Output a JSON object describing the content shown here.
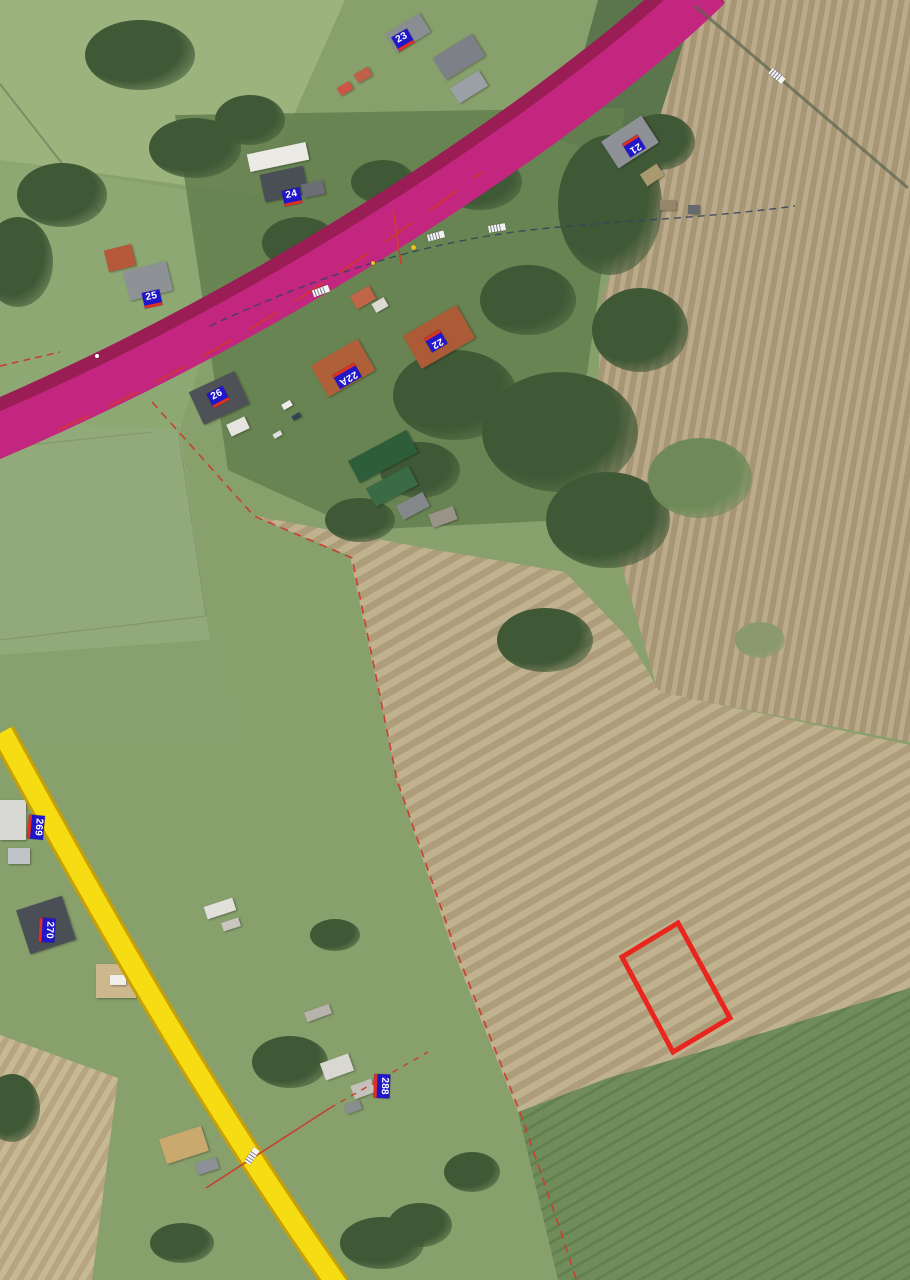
{
  "map": {
    "type": "aerial-orthophoto-with-cadastral-overlay",
    "colors": {
      "road_primary_fill": "#c2267f",
      "road_primary_casing": "#9a1d55",
      "road_primary_edge_red": "#d4372a",
      "road_secondary_fill": "#f6dc12",
      "road_secondary_casing": "#c79f06",
      "parcel_highlight": "#e8261d",
      "boundary_red": "#c8402f",
      "utility_dashed": "#34465c",
      "track_line": "#5a6450",
      "house_label_bg": "#1f17c9",
      "house_label_text": "#ffffff",
      "house_label_underline": "#e03020",
      "marker_yellow": "#e6c31e",
      "marker_white": "#ffffff"
    },
    "house_labels": [
      {
        "text": "23",
        "x": 403,
        "y": 40,
        "rot": -30
      },
      {
        "text": "24",
        "x": 292,
        "y": 197,
        "rot": -12
      },
      {
        "text": "25",
        "x": 152,
        "y": 299,
        "rot": -12
      },
      {
        "text": "21",
        "x": 634,
        "y": 146,
        "rot": 148
      },
      {
        "text": "22",
        "x": 436,
        "y": 341,
        "rot": 150
      },
      {
        "text": "22A",
        "x": 347,
        "y": 376,
        "rot": 150
      },
      {
        "text": "26",
        "x": 218,
        "y": 397,
        "rot": -28
      },
      {
        "text": "269",
        "x": 36,
        "y": 827,
        "rot": 95
      },
      {
        "text": "270",
        "x": 47,
        "y": 930,
        "rot": 93
      },
      {
        "text": "288",
        "x": 382,
        "y": 1086,
        "rot": 92
      }
    ],
    "road_ref_labels": [
      {
        "x": 321,
        "y": 291,
        "rot": -20
      },
      {
        "x": 436,
        "y": 236,
        "rot": -15
      },
      {
        "x": 497,
        "y": 228,
        "rot": -10
      },
      {
        "x": 777,
        "y": 76,
        "rot": 40
      },
      {
        "x": 252,
        "y": 1156,
        "rot": -55
      }
    ],
    "point_markers": [
      {
        "x": 413,
        "y": 247,
        "color": "#e6c31e",
        "size": 5
      },
      {
        "x": 97,
        "y": 356,
        "color": "#ffffff",
        "size": 4
      },
      {
        "x": 373,
        "y": 263,
        "color": "#e6c31e",
        "size": 4
      }
    ],
    "highlighted_parcel": {
      "points": "678,923 730,1018 673,1052 622,957",
      "stroke_width": 5
    }
  }
}
